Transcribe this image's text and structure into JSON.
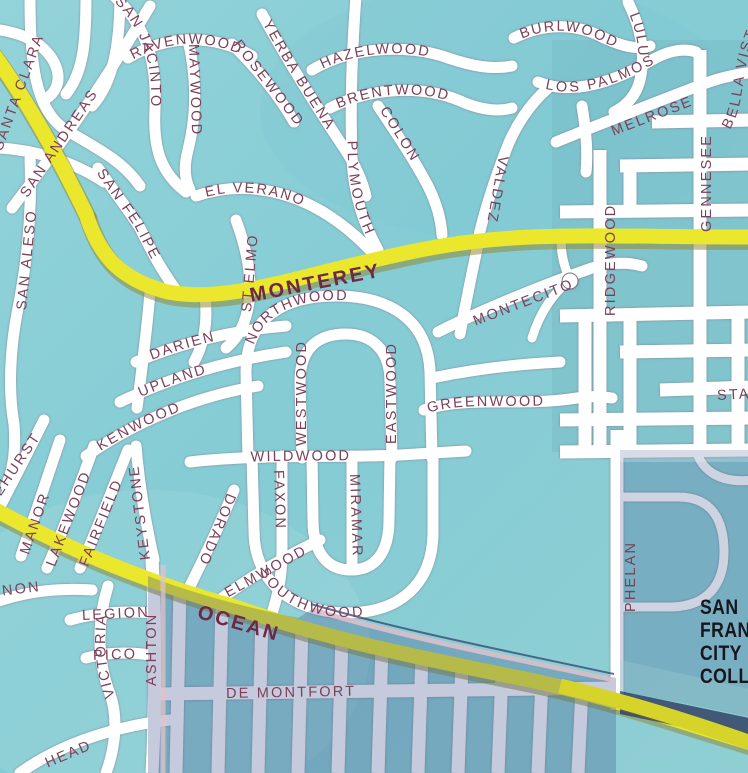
{
  "map": {
    "college": [
      "SAN",
      "FRANCISCO",
      "CITY",
      "COLLEGE"
    ],
    "major_roads": {
      "monterey": "MONTEREY",
      "ocean": "OCEAN",
      "santa_clara": "SANTA CLARA"
    },
    "streets": {
      "san_jacinto": "SAN JACINTO",
      "ravenwood": "RAVENWOOD",
      "maywood": "MAYWOOD",
      "rosewood": "ROSEWOOD",
      "yerba_buena": "YERBA BUENA",
      "hazelwood": "HAZELWOOD",
      "brentwood": "BRENTWOOD",
      "colon": "COLON",
      "plymouth": "PLYMOUTH",
      "el_verano": "EL VERANO",
      "san_andreas": "SAN ANDREAS",
      "san_aleso": "SAN ALESO",
      "san_felipe": "SAN FELIPE",
      "st_elmo": "ST ELMO",
      "burlwood": "BURLWOOD",
      "lulu": "LULU",
      "los_palmos": "LOS PALMOS",
      "melrose": "MELROSE",
      "bella_vista": "BELLA VISTA",
      "gennessee": "GENNESEE",
      "valdez": "VALDEZ",
      "montecito": "MONTECITO",
      "ridgewood": "RIDGEWOOD",
      "stanley": "STANLEY",
      "northwood": "NORTHWOOD",
      "darien": "DARIEN",
      "upland": "UPLAND",
      "kenwood": "KENWOOD",
      "wildwood": "WILDWOOD",
      "westwood": "WESTWOOD",
      "eastwood": "EASTWOOD",
      "miramar": "MIRAMAR",
      "greenwood": "GREENWOOD",
      "faxon": "FAXON",
      "dorado": "DORADO",
      "elmwood": "ELMWOOD",
      "southwood": "SOUTHWOOD",
      "keystone": "KEYSTONE",
      "fairfield": "FAIRFIELD",
      "lakewood": "LAKEWOOD",
      "manor": "MANOR",
      "pinehurst": "PINEHURST",
      "vernon": "VERNON",
      "victoria": "VICTORIA",
      "legion": "LEGION",
      "pico": "PICO",
      "head": "HEAD",
      "ashton": "ASHTON",
      "de_montfort": "DE MONTFORT",
      "phelan": "PHELAN"
    }
  },
  "colors": {
    "water_teal_base": "#86CCD5",
    "teal_light": "#97D5DB",
    "teal_deep": "#79C4CF",
    "street_white": "#FFFFFF",
    "street_casing": "#7E7386",
    "road_yellow": "#EAE72C",
    "road_yellow_shadow": "#8F8D3C",
    "label_ink": "#7C4058",
    "major_label_ink": "#6D2846",
    "overlay_slate": "#3F548A",
    "overlay_edge_rose": "#E0C2CB",
    "overlay_edge_navy": "#33406F",
    "shadow_navy": "#2E3A5E",
    "college_text": "#16161C"
  }
}
